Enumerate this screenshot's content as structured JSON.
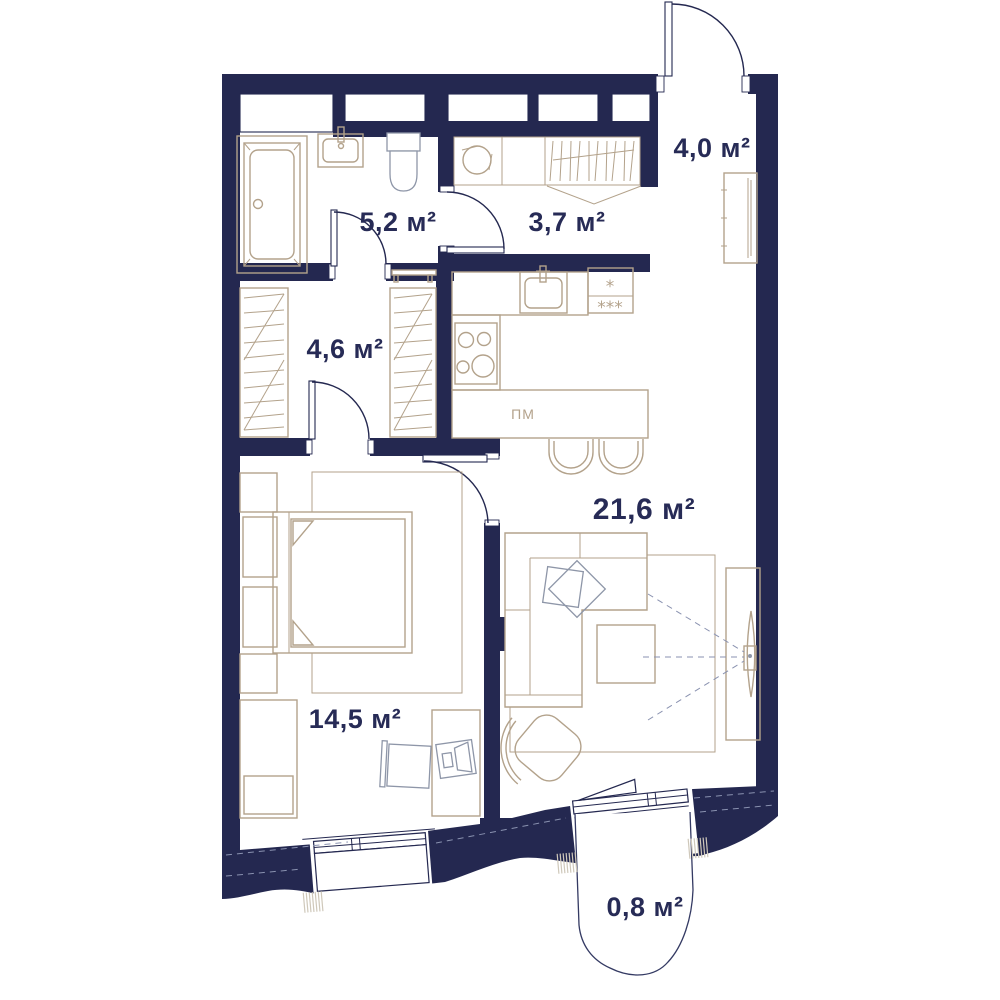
{
  "rooms": [
    {
      "id": "entry-hall",
      "area": "4,0 м²"
    },
    {
      "id": "bathroom",
      "area": "5,2 м²"
    },
    {
      "id": "hall",
      "area": "3,7 м²"
    },
    {
      "id": "wardrobe",
      "area": "4,6 м²"
    },
    {
      "id": "living-kitchen",
      "area": "21,6 м²"
    },
    {
      "id": "bedroom",
      "area": "14,5 м²"
    },
    {
      "id": "balcony",
      "area": "0,8 м²"
    }
  ],
  "kitchen": {
    "dishwasher_label": "ПМ",
    "fridge_star_top": "*",
    "fridge_star_bottom": "***"
  },
  "colors": {
    "wall": "#242850",
    "furniture": "#b3a28b",
    "gray_fixture": "#8e96a8",
    "label": "#272b56",
    "background": "#ffffff"
  }
}
